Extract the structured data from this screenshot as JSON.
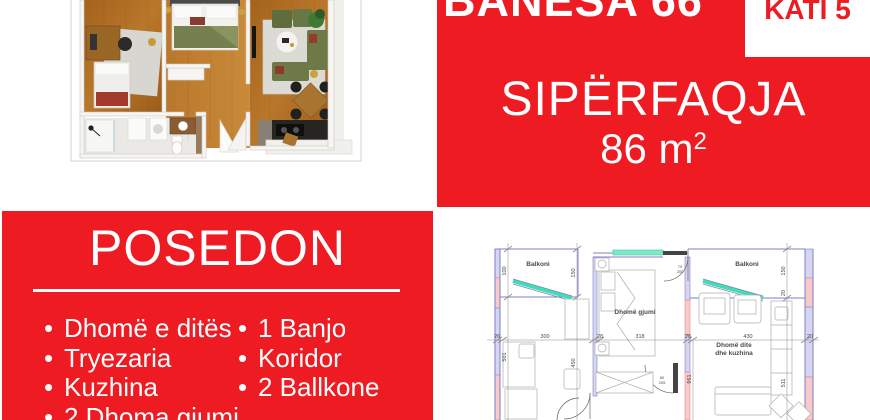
{
  "colors": {
    "accent_red": "#ee1b23",
    "text_on_red": "#ffffff",
    "plan_wall_blue": "#7f7fc8",
    "plan_wall_pink_fill": "#f9caca",
    "plan_wall_lavender_fill": "#d6d6f0",
    "plan_window_cyan": "#3fe0b0",
    "wood_floor_brown": "#b5732a"
  },
  "header": {
    "title": "BANESA 66",
    "floor_badge": "KATI 5",
    "area_label": "SIPËRFAQJA",
    "area_value": "86 m",
    "area_superscript": "2"
  },
  "features": {
    "title": "POSEDON",
    "bullet": "•",
    "items_left": [
      "Dhomë e ditës",
      "Tryezaria",
      "Kuzhina",
      "2 Dhoma gjumi"
    ],
    "items_right": [
      "1 Banjo",
      "Koridor",
      "2 Ballkone"
    ]
  },
  "plan_2d": {
    "rooms": {
      "balcony_left": "Balkoni",
      "balcony_right": "Balkoni",
      "bedroom": "Dhomë gjumi",
      "living_line1": "Dhomë dite",
      "living_line2": "dhe kuzhina"
    },
    "dimensions": {
      "h_26_left": "26",
      "h_300": "300",
      "h_28": "28",
      "h_318": "318",
      "h_26_mid": "26",
      "h_430": "430",
      "h_20_right": "20",
      "v_100": "100",
      "v_150_left": "150",
      "v_501": "501",
      "v_450": "450",
      "v_150_right": "150",
      "v_20": "20",
      "v_961": "961",
      "v_511": "511",
      "door_top_w": "70",
      "door_top_h": "200",
      "door_mid_w": "80",
      "door_mid_h": "205"
    }
  }
}
